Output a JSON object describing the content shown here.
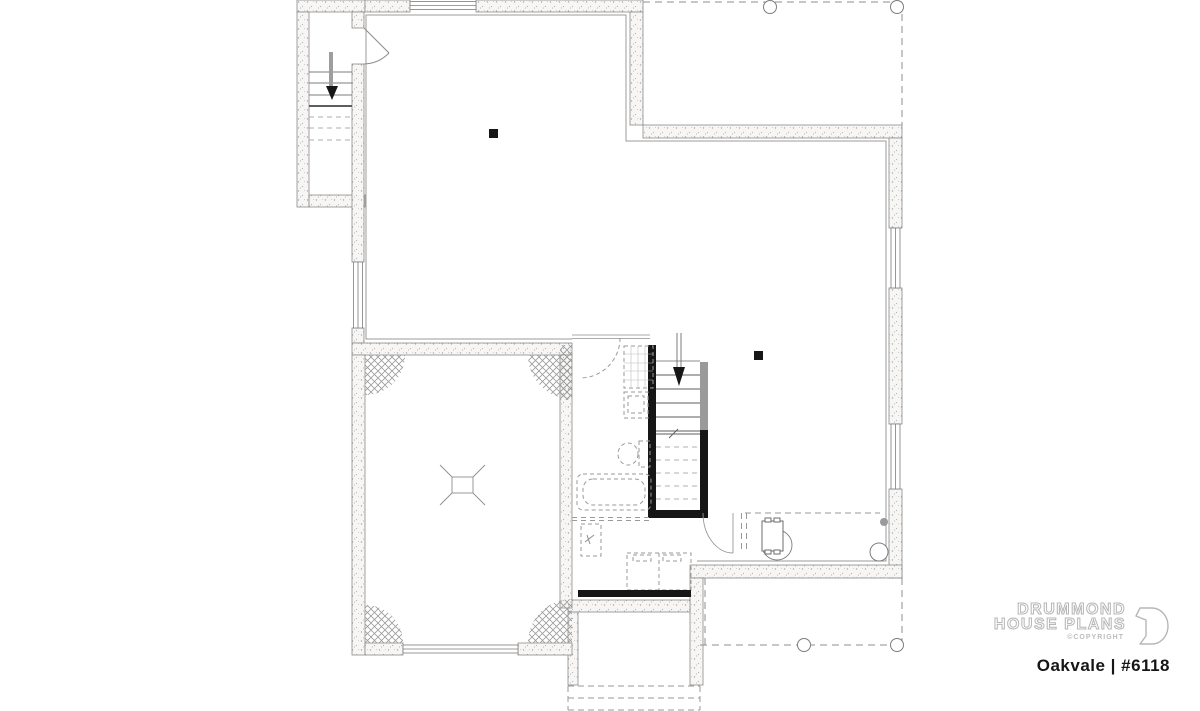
{
  "branding": {
    "line1": "DRUMMOND",
    "line2": "HOUSE PLANS",
    "copyright": "©COPYRIGHT",
    "plan_name": "Oakvale | #6118"
  },
  "drawing": {
    "symbols": [
      "down-arrow-icon",
      "support-post-icon",
      "floor-drain-icon",
      "furnace-icon",
      "water-heater-icon",
      "sump-pit-icon",
      "toilet-icon",
      "bathtub-icon",
      "shower-icon",
      "vanity-icon",
      "laundry-tub-icon",
      "door-swing-icon",
      "window-icon",
      "porch-post-icon",
      "stair-treads-icon"
    ]
  },
  "palette": {
    "wall_fill": "#f7f6f4",
    "wall_speckle": "#ababab",
    "line": "#777777",
    "black_wall": "#161616",
    "dashed": "#9a9a9a",
    "brand_gray": "#b7b7b7",
    "text_black": "#161616"
  }
}
